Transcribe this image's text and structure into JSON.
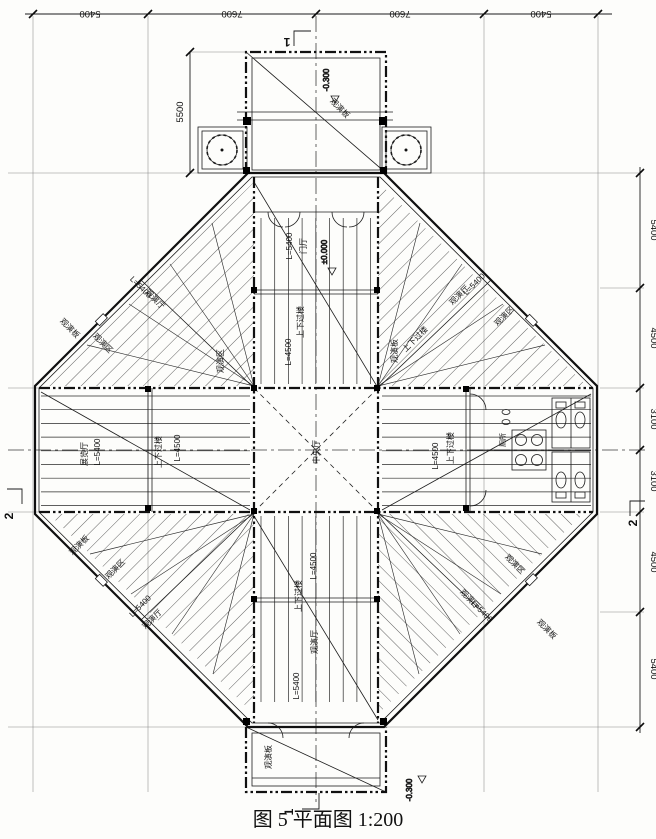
{
  "caption": "图 5  平面图 1:200",
  "dimensions": {
    "top": [
      "5400",
      "7600",
      "7600",
      "5400"
    ],
    "right": [
      "5400",
      "4500",
      "3100",
      "3100",
      "4500",
      "5400"
    ],
    "porch_depth": "5500"
  },
  "levels": {
    "zero": "±0.000",
    "minus_300": "-0.300"
  },
  "sections": {
    "one": "1",
    "two": "2"
  },
  "rooms": {
    "central_hall": "中央厅",
    "entrance_hall": "门厅",
    "exhibition_hall": "展览厅",
    "stair_hall": "上下过楼",
    "viewing_hall": "观演厅",
    "viewing_area": "观演区",
    "viewing_platform": "观演板",
    "toilet": "厕所",
    "len_5400": "L=5400",
    "len_4500": "L=4500"
  },
  "colors": {
    "ink": "#111111",
    "paper": "#fdfdfb"
  }
}
